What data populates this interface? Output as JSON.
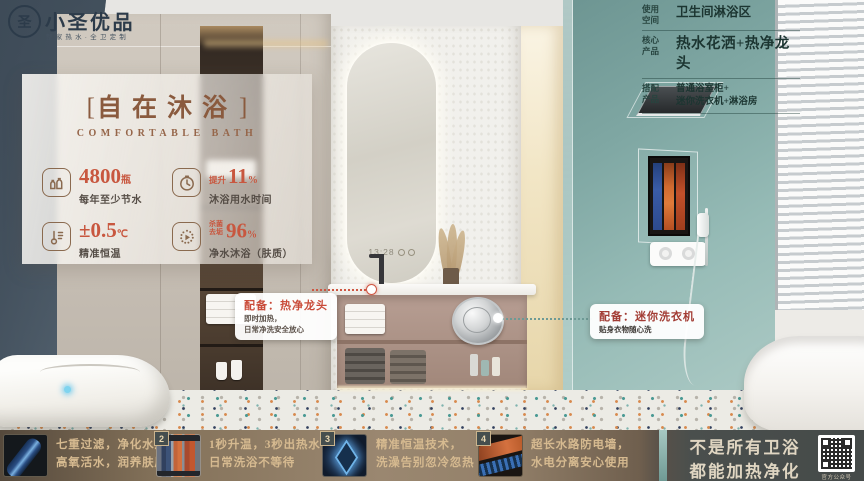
{
  "brand": {
    "name": "小圣优品",
    "tagline": "整家热水·全卫定制",
    "logo_glyph": "圣"
  },
  "glass_panel": {
    "bracket_left": "[",
    "title": "自在沐浴",
    "bracket_right": "]",
    "subtitle": "COMFORTABLE BATH",
    "features": [
      {
        "icon": "water-bottles-icon",
        "value": "4800",
        "unit": "瓶",
        "desc": "每年至少节水"
      },
      {
        "icon": "timer-icon",
        "prefix": "提升",
        "value": "11",
        "unit": "%",
        "desc": "沐浴用水时间"
      },
      {
        "icon": "thermometer-icon",
        "value": "±0.5",
        "unit": "℃",
        "desc": "精准恒温"
      },
      {
        "icon": "purify-icon",
        "prefix_line1": "杀菌",
        "prefix_line2": "去垢",
        "value": "96",
        "unit": "%",
        "desc": "净水沐浴（肤质）"
      }
    ]
  },
  "info_table": {
    "rows": [
      {
        "label_line1": "使用",
        "label_line2": "空间",
        "value": "卫生间淋浴区"
      },
      {
        "label_line1": "核心",
        "label_line2": "产品",
        "value": "热水花洒+热净龙头"
      },
      {
        "label_line1": "搭配",
        "label_line2": "产品",
        "value": "普通浴室柜+",
        "value2": "迷你洗衣机+淋浴房"
      }
    ]
  },
  "callouts": [
    {
      "title": "配备：热净龙头",
      "line1": "即时加热，",
      "line2": "日常净洗安全放心"
    },
    {
      "title": "配备：迷你洗衣机",
      "line1": "贴身衣物随心洗"
    }
  ],
  "mirror": {
    "time": "13:28"
  },
  "bottom_bar": {
    "items": [
      {
        "num": "",
        "thumb": "filter-cartridge",
        "line1": "七重过滤，净化水源，",
        "line2": "高氧活水，润养肤质"
      },
      {
        "num": "2",
        "thumb": "heating-tubes",
        "line1": "1秒升温，3秒出热水，",
        "line2": "日常洗浴不等待"
      },
      {
        "num": "3",
        "thumb": "ai-chip",
        "line1": "精准恒温技术，",
        "line2": "洗澡告别忽冷忽热"
      },
      {
        "num": "4",
        "thumb": "anti-electric-wall",
        "line1": "超长水路防电墙，",
        "line2": "水电分离安心使用"
      }
    ],
    "slogan_line1": "不是所有卫浴",
    "slogan_line2": "都能加热净化",
    "qr_label": "官方公众号"
  },
  "colors": {
    "accent_brown": "#8a5a3e",
    "accent_red": "#c8573f",
    "callout_red": "#cb4a3a",
    "teal_wall": "#8fb5b1",
    "strip_text": "#d6bb92"
  }
}
